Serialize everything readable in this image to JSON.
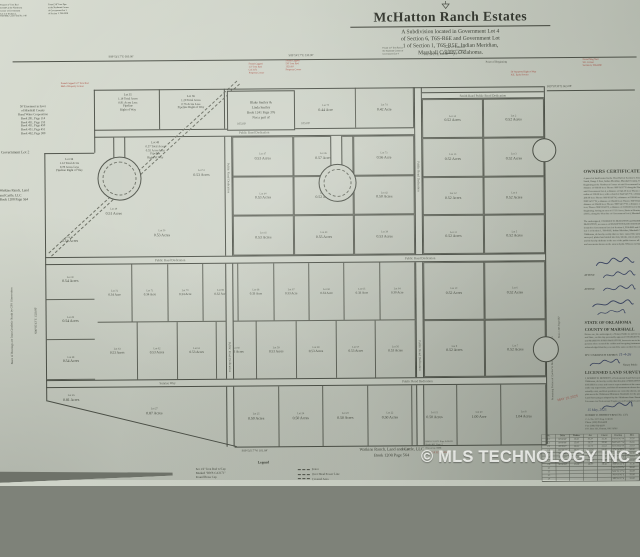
{
  "watermark": "© MLS TECHNOLOGY INC 2026",
  "title_block": {
    "title": "McHatton Ranch Estates",
    "subtitle": [
      "A Subdivision located in Government Lot 4",
      "of Section 6, T6S-R6E and Government Lot",
      "1 of Section 1, T6S-R5E, Indian Meridian,",
      "Marshall County, Oklahoma."
    ],
    "subnote_a": [
      "Found 1/2\" Iron Rod at",
      "the Southeast Corner of",
      "Government Lot 4"
    ],
    "subnote_b": [
      "Found 1/2\" Iron Rod at",
      "the Southwest Corner of",
      "Government Lot 1"
    ]
  },
  "corner_notes": {
    "top_left_1": [
      "Found 1/2\" Iron Rod",
      "LS1357 at the Northwest",
      "Corner of Government",
      "Lot 4 of Section 1,",
      "T6S-R5E, CCR Filed No. 140"
    ],
    "top_left_2": [
      "Found 3/8\" Iron Pipe",
      "at the Northeast Corner",
      "of Government Lot 1",
      "of Section 1, T6S-R5E"
    ],
    "easement": [
      "50' Easement in favor",
      "of Marshall County",
      "Rural Water Corporation",
      "Book 281, Page 114",
      "Book 451, Page 152",
      "Book 451, Page 450",
      "Book 451, Page 451",
      "Book 462, Page 380"
    ],
    "government_lot": "Government Lot 2",
    "watkins_left": [
      "Watkins Ranch, Land",
      "and Cattle, LLC",
      "Book 1208 Page 564"
    ],
    "basis_of_bearings": "Basis of Bearings are from Geodetic North by GPS Observation",
    "remaining_portion_1": "Remaining Portion of Charles W. McHatton & Marilyn Jones",
    "remaining_portion_2": "Book 1263 Page 687"
  },
  "red_notes": {
    "top_center_a": [
      "Found Capped",
      "1/2\" Iron Rod",
      "CA 3171",
      "Property Corner"
    ],
    "top_center_b": [
      "Found Capped",
      "5/8\" Iron Rod",
      "1320.00'",
      "Property Corner"
    ],
    "top_right_a": [
      "50' Statutory Right of Way",
      "N.E. Early Service"
    ],
    "top_right_b": [
      "Found Mag Nail",
      "S.E. Corner",
      "Section 6, T6S-R6E"
    ],
    "left_edge": [
      "Found Capped 1/2\" Iron Rod",
      "Half of Property Corner"
    ],
    "filed": "CA 3171  6-30-26",
    "stamp": "MAY 15 2025"
  },
  "dims": {
    "top_1": "S89°54'17\"E  660.00'",
    "top_2": "S89°54'17\"E  330.00'",
    "top_3": "S89°54'17\"E  165.00'",
    "pob": "Point of Beginning",
    "right_line": "S89°58'30\"E  663.08'",
    "mid_1": "105.00'",
    "mid_2": "105.00'",
    "bottom_1": "S89°54'17\"W  101.84'",
    "bottom_2": "996.00'",
    "left_vert": "N00°05'43\"E  1320.00'"
  },
  "streets": {
    "label": "Public Road Dedication",
    "smith_road": "Smith Road    Public Road Dedication",
    "sunrise_way": "Sunrise Way"
  },
  "special_lots": {
    "lot35": [
      "Lot 35",
      "1.14 Total Acres",
      "0.81 Acres Less",
      "Pipeline",
      "Right of Way"
    ],
    "lot36": [
      "Lot 36",
      "1.20 Total Acres",
      "0.76 Acres Less",
      "Pipeline Right of Way"
    ],
    "lot48": [
      "Lot 48",
      "0.57 Total Acres",
      "0.55 Acres Less",
      "Pipeline",
      "Right of Way"
    ],
    "lot34": [
      "Lot 34",
      "1.12 Total Acres",
      "0.78 Acres Less",
      "Pipeline Right of Way"
    ]
  },
  "grid_lots": {
    "tr": [
      {
        "lot": "Lot 75",
        "acre": "0.44 Acre"
      },
      {
        "lot": "Lot 74",
        "acre": "0.42 Acre"
      }
    ],
    "right_upper": [
      {
        "lot": "Lot 14",
        "acre": "0.52 Acres"
      },
      {
        "lot": "Lot 2",
        "acre": "0.52 Acres"
      },
      {
        "lot": "Lot 13",
        "acre": "0.52 Acres"
      },
      {
        "lot": "Lot 3",
        "acre": "0.52 Acres"
      },
      {
        "lot": "Lot 12",
        "acre": "0.52 Acres"
      },
      {
        "lot": "Lot 4",
        "acre": "0.52 Acres"
      },
      {
        "lot": "Lot 11",
        "acre": "0.52 Acres"
      },
      {
        "lot": "Lot 5",
        "acre": "0.52 Acres"
      }
    ],
    "right_lower": [
      {
        "lot": "Lot 10",
        "acre": "0.52 Acres"
      },
      {
        "lot": "Lot 6",
        "acre": "0.52 Acres"
      },
      {
        "lot": "Lot 9",
        "acre": "0.52 Acres"
      },
      {
        "lot": "Lot 7",
        "acre": "0.52 Acres"
      }
    ],
    "center": [
      {
        "lot": "Lot 47",
        "acre": "0.53 Acres"
      },
      {
        "lot": "Lot 46",
        "acre": "0.57 Acres"
      },
      {
        "lot": "Lot 73",
        "acre": "0.56 Acre"
      },
      {
        "lot": "Lot 44",
        "acre": "0.53 Acres"
      },
      {
        "lot": "Lot 43",
        "acre": "0.52 Acres"
      },
      {
        "lot": "Lot 42",
        "acre": "0.50 Acres"
      },
      {
        "lot": "Lot 41",
        "acre": "0.53 Acres"
      },
      {
        "lot": "Lot 40",
        "acre": "0.55 Acres"
      },
      {
        "lot": "Lot 39",
        "acre": "0.53 Acres"
      }
    ],
    "around_circle1": [
      {
        "lot": "Lot 49",
        "acre": "0.51 Acres"
      },
      {
        "lot": "Lot 50",
        "acre": "0.53 Acres"
      },
      {
        "lot": "Lot 51",
        "acre": "0.53 Acres"
      }
    ],
    "left_col": [
      {
        "lot": "Lot 31",
        "acre": "0.54 Acres"
      },
      {
        "lot": "Lot 30",
        "acre": "0.54 Acres"
      },
      {
        "lot": "Lot 29",
        "acre": "0.54 Acres"
      },
      {
        "lot": "Lot 28",
        "acre": "0.54 Acres"
      }
    ],
    "lot26": {
      "lot": "Lot 26",
      "acre": "0.81 Acres"
    },
    "lot27": {
      "lot": "Lot 27",
      "acre": "0.87 Acres"
    },
    "band_upper": [
      {
        "lot": "Lot 72",
        "acre": "0.34 Acre"
      },
      {
        "lot": "Lot 71",
        "acre": "0.34 Acre"
      },
      {
        "lot": "Lot 70",
        "acre": "0.34 Acre"
      },
      {
        "lot": "Lot 69",
        "acre": "0.32 Acre"
      },
      {
        "lot": "Lot 68",
        "acre": "0.33 Acre"
      },
      {
        "lot": "Lot 67",
        "acre": "0.33 Acre"
      },
      {
        "lot": "Lot 66",
        "acre": "0.33 Acre"
      },
      {
        "lot": "Lot 65",
        "acre": "0.33 Acre"
      },
      {
        "lot": "Lot 64",
        "acre": "0.30 Acre"
      }
    ],
    "band_lower": [
      {
        "lot": "Lot 63",
        "acre": "0.53 Acres"
      },
      {
        "lot": "Lot 62",
        "acre": "0.53 Acres"
      },
      {
        "lot": "Lot 61",
        "acre": "0.53 Acres"
      },
      {
        "lot": "Lot 60",
        "acre": "0.53 Acres"
      },
      {
        "lot": "Lot 59",
        "acre": "0.53 Acres"
      },
      {
        "lot": "Lot 58",
        "acre": "0.53 Acres"
      },
      {
        "lot": "Lot 57",
        "acre": "0.53 Acres"
      },
      {
        "lot": "Lot 56",
        "acre": "0.53 Acres"
      }
    ],
    "bottom_row": [
      {
        "lot": "Lot 25",
        "acre": "0.50 Acres"
      },
      {
        "lot": "Lot 24",
        "acre": "0.50 Acres"
      },
      {
        "lot": "Lot 23",
        "acre": "0.50 Acres"
      },
      {
        "lot": "Lot 22",
        "acre": "0.50 Acres"
      },
      {
        "lot": "Lot 21",
        "acre": "0.50 Acres"
      },
      {
        "lot": "Lot 20",
        "acre": "1.00 Acre"
      },
      {
        "lot": "Lot 8",
        "acre": "1.04 Acres"
      }
    ]
  },
  "smiley_box": [
    "Blake Smiley &",
    "Linda Smiley",
    "Book 1241 Page 376",
    "Not a part of"
  ],
  "panel": {
    "owners_heading": "OWNERS CERTIFICATE & DEDICATION",
    "legal_lines": [
      "A parcel of land located in the West Half of Section 6, Township 6",
      "South, Range 6 East, Indian Meridian, Marshall County, Oklahoma.",
      "Beginning at the Northwest Corner of said Government Lot 4, a",
      "distance of 660.00 feet; Thence S89°54'17\"E along the North line of",
      "said Government Lot 4, a distance of 645.26 feet; Thence with a",
      "radius of 330.00 feet, with a chord of S44°54'17\"E, a distance of",
      "466.69 feet; Thence S00°05'43\"W, a distance of 330.00 feet; Thence",
      "N89°54'17\"W, a distance of 264.00 feet; Thence S00°05'43\"W, a",
      "distance of 264.00 feet; Thence N89°54'17\"W, a distance of 996.00",
      "feet; Thence N00°05'43\"E, a distance of 1320.00 feet to the Point of",
      "Beginning, having an area of 17.25 Acres, Basis of Bearings NAD 83",
      "(2011), along the West line of Government Lot 4, Marshall County."
    ],
    "dedication_lines": [
      "The undersigned, CHARLES W. McHATTON and MARILYN JONES",
      "McHATTON, as owners of McHATTON RANCH ESTATES, a subdivision",
      "located in Government Lot 4 of Section 6, T6S-R6E and Government",
      "Lot 1 of Section 1, T6S-R5E, Indian Meridian, Marshall County,",
      "Oklahoma, do hereby certify that we have caused the same to be",
      "surveyed, platted and staked into lots, blocks, streets and easements,",
      "and do hereby dedicate to the use of the public forever all streets",
      "and easements shown on the annexed plat. Witness our hands."
    ],
    "attest": "ATTEST:",
    "state1": "STATE OF OKLAHOMA",
    "state2": "COUNTY OF MARSHALL",
    "notary_lines": [
      "Before me, the undersigned, a Notary Public in and for said County",
      "and State, on this day personally appeared CHARLES W. McHATTON",
      "and MARILYN JONES McHATTON, known to me to be the identical",
      "persons who executed the within and foregoing instrument, and",
      "acknowledged that they executed the same as their free act and deed."
    ],
    "commission": "MY COMMISSION EXPIRES:",
    "commission_date": "11-4-26",
    "notary_public": "Notary Public",
    "surveyor_heading": "LICENSED LAND SURVEYOR",
    "surveyor_lines": [
      "I, ROBERT D. BENNETT, a Professional Land Surveyor in the State of",
      "Oklahoma, do hereby certify that this plat of McHATTON RANCH",
      "ESTATES is a true and correct representation of the survey made",
      "under my supervision, and that all monuments shown hereon",
      "actually exist, and their positions are correctly shown, and that this",
      "plat meets the Oklahoma Minimum Standards for the practice of",
      "Land Surveying as adopted by the Oklahoma State Board of",
      "Licensure for Professional Engineers and Land Surveyors."
    ],
    "surveyor_date": "15   May, 2025",
    "surveyor_name": "ROBERT D. BENNETT   RPLS No. 1371",
    "contact_lines": [
      "C.A. No. 3171   Exp. 6-30-26",
      "Phone (580) 924-4428",
      "Fax (580) 924-4429",
      "P.O. Box 231, Durant, OK 74702"
    ]
  },
  "notes_block": [
    "RWS CA3171   Exp. 6-30-26",
    "Book 403, Page 2",
    "Drawn by: RDB"
  ],
  "curve_table": {
    "headers": [
      "No.",
      "Delta",
      "Radius",
      "Arc",
      "Chord",
      "Bearing",
      "Dist."
    ],
    "rows": [
      [
        "C1",
        "90°00'00\"",
        "25.00'",
        "39.27'",
        "35.36'",
        "S45°05'43\"W",
        "35.36'"
      ],
      [
        "C2",
        "90°00'00\"",
        "25.00'",
        "39.27'",
        "35.36'",
        "N44°54'17\"W",
        "35.36'"
      ],
      [
        "C3",
        "38°39'37\"",
        "50.00'",
        "33.74'",
        "33.10'",
        "S19°25'32\"W",
        "33.10'"
      ],
      [
        "C4",
        "141°20'23\"",
        "50.00'",
        "123.34'",
        "94.40'",
        "S70°34'28\"E",
        "94.40'"
      ],
      [
        "C5",
        "90°00'00\"",
        "25.00'",
        "39.27'",
        "35.36'",
        "S44°54'17\"E",
        "35.36'"
      ],
      [
        "C6",
        "38°39'37\"",
        "50.00'",
        "33.74'",
        "33.10'",
        "N19°25'32\"E",
        "33.10'"
      ],
      [
        "C7",
        "141°20'23\"",
        "50.00'",
        "123.34'",
        "94.40'",
        "N70°34'28\"W",
        "94.40'"
      ],
      [
        "C8",
        "90°00'00\"",
        "25.00'",
        "39.27'",
        "35.36'",
        "N45°05'43\"E",
        "35.36'"
      ],
      [
        "L1",
        "",
        "",
        "",
        "",
        "S00°05'43\"W",
        "50.00'"
      ],
      [
        "L2",
        "",
        "",
        "",
        "",
        "N89°54'17\"W",
        "50.00'"
      ],
      [
        "L3",
        "",
        "",
        "",
        "",
        "N00°05'43\"E",
        "50.00'"
      ],
      [
        "L4",
        "",
        "",
        "",
        "",
        "S89°54'17\"E",
        "50.00'"
      ]
    ]
  },
  "legend": {
    "heading": "Legend",
    "left": [
      "Set 1/2\" Iron Rod w/Cap",
      "Marked \"RWS CA3171\"",
      "Found Brass Cap"
    ],
    "right": [
      "Fence",
      "Over Head Power Line",
      "Covered Area"
    ]
  },
  "bottom_owner": [
    "Watkins Ranch, Land and Cattle, LLC",
    "Book 1208 Page 564"
  ]
}
